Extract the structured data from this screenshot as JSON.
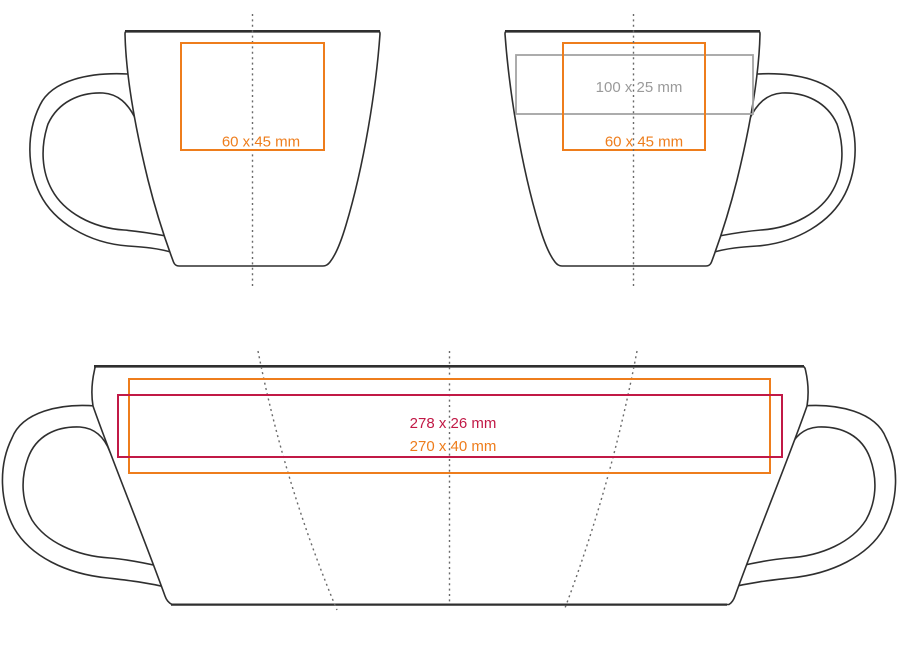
{
  "document": {
    "kind": "mug print-area template",
    "views": [
      "front",
      "side",
      "wrap"
    ]
  },
  "colors": {
    "orange": "#ee7d1c",
    "wrap_red": "#c11946",
    "band_gray": "#a3a3a3",
    "label_gray": "#9a9a9a",
    "outline": "#2f2f2f",
    "guide": "#6a6a6a"
  },
  "views": {
    "front": {
      "print_areas": [
        {
          "size_label": "60 x 45 mm",
          "color_key": "orange"
        }
      ]
    },
    "side": {
      "print_areas": [
        {
          "size_label": "100 x 25 mm",
          "color_key": "band_gray"
        },
        {
          "size_label": "60 x 45 mm",
          "color_key": "orange"
        }
      ]
    },
    "wrap": {
      "print_areas": [
        {
          "size_label": "278 x 26 mm",
          "color_key": "wrap_red"
        },
        {
          "size_label": "270 x 40 mm",
          "color_key": "orange"
        }
      ]
    }
  }
}
